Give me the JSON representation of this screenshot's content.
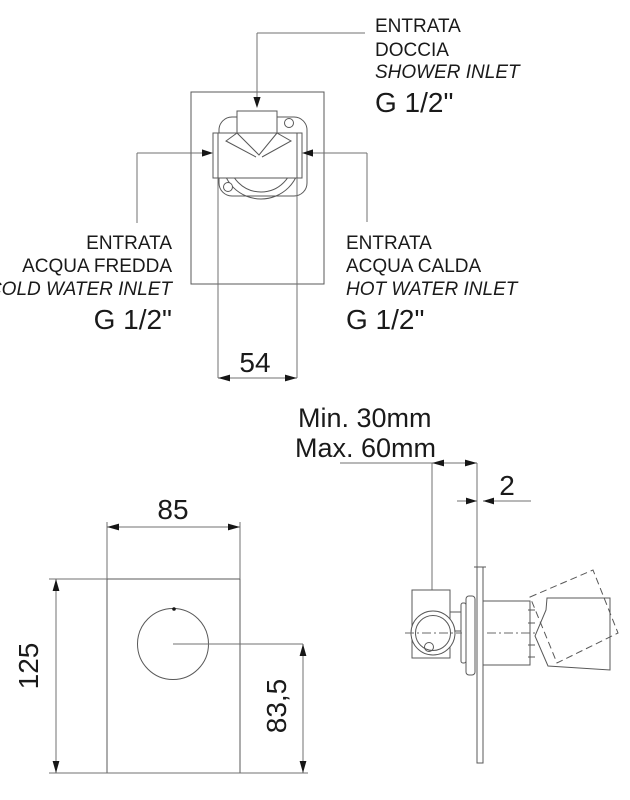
{
  "colors": {
    "background": "#ffffff",
    "drawing_line": "#585858",
    "dimension_line": "#707070",
    "text": "#1a1a1a"
  },
  "top_view": {
    "dim_width": "54",
    "shower_inlet_label": {
      "l1": "ENTRATA",
      "l2": "DOCCIA",
      "l3": "SHOWER INLET",
      "thread": "G 1/2\""
    },
    "cold_water_label": {
      "l1": "ENTRATA",
      "l2": "ACQUA FREDDA",
      "l3": "COLD WATER INLET",
      "thread": "G 1/2\""
    },
    "hot_water_label": {
      "l1": "ENTRATA",
      "l2": "ACQUA CALDA",
      "l3": "HOT WATER INLET",
      "thread": "G 1/2\""
    }
  },
  "front_view": {
    "dim_width": "85",
    "dim_height": "125",
    "dim_center_from_bottom": "83,5"
  },
  "side_view": {
    "dim_depth_min": "Min. 30mm",
    "dim_depth_max": "Max. 60mm",
    "dim_plate_thickness": "2"
  }
}
